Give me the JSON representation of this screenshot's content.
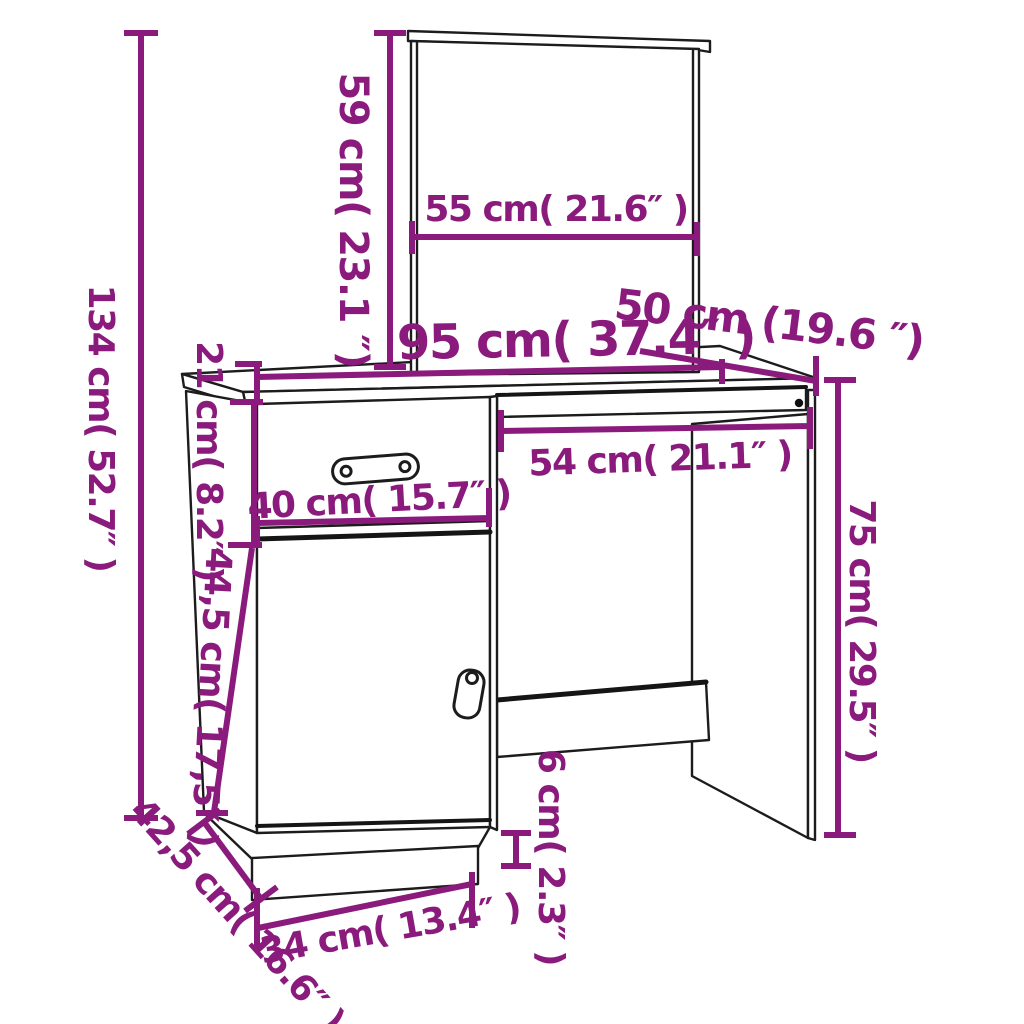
{
  "title": "Dressing table with mirror — dimension diagram",
  "colors": {
    "dimension": "#8a1b7d",
    "outline": "#1c1c1c",
    "background": "#ffffff"
  },
  "units": [
    "cm",
    "inch"
  ],
  "labels": [
    {
      "id": "total-height",
      "text": "134 cm( 52.7″ )"
    },
    {
      "id": "mirror-height",
      "text": "59 cm( 23.1 ″)"
    },
    {
      "id": "mirror-width",
      "text": "55 cm( 21.6″ )"
    },
    {
      "id": "desk-width",
      "text": "95 cm( 37.4″ )"
    },
    {
      "id": "desk-depth",
      "text": "50 cm (19.6 ″)"
    },
    {
      "id": "drawer-height",
      "text": "21 cm( 8.2″ )"
    },
    {
      "id": "drawer-width",
      "text": "40 cm( 15.7″ )"
    },
    {
      "id": "knee-width",
      "text": "54 cm( 21.1″ )"
    },
    {
      "id": "panel-height",
      "text": "75 cm( 29.5″ )"
    },
    {
      "id": "door-height",
      "text": "44,5 cm( 17,5″ )"
    },
    {
      "id": "plinth-height",
      "text": "6 cm( 2.3″ )"
    },
    {
      "id": "plinth-width",
      "text": "34 cm( 13.4″ )"
    },
    {
      "id": "cabinet-depth",
      "text": "42,5 cm( 16.6″ )"
    }
  ]
}
